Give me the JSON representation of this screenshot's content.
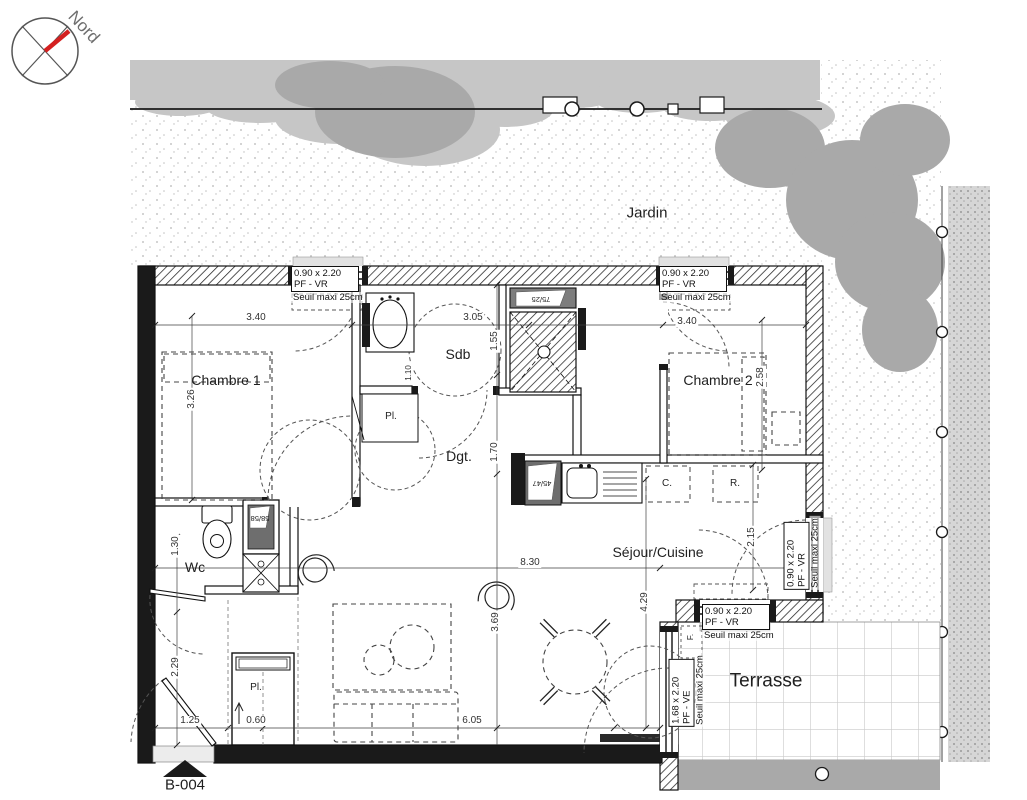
{
  "compass": {
    "north_label": "Nord"
  },
  "areas": {
    "garden": "Jardin",
    "terrace": "Terrasse",
    "unit_ref": "B-004"
  },
  "rooms": {
    "chambre1": "Chambre 1",
    "chambre2": "Chambre 2",
    "bathroom": "Sdb",
    "hallway": "Dgt.",
    "living_kitchen": "Séjour/Cuisine",
    "wc": "Wc",
    "closet_hall": "Pl.",
    "closet_entry": "Pl."
  },
  "openings": {
    "window_top_left": {
      "size": "0.90 x 2.20",
      "type": "PF - VR",
      "sill": "Seuil maxi 25cm"
    },
    "window_top_right": {
      "size": "0.90 x 2.20",
      "type": "PF - VR",
      "sill": "Seuil maxi 25cm"
    },
    "window_right": {
      "size": "0.90 x 2.20",
      "type": "PF - VR",
      "sill": "Seuil maxi 25cm"
    },
    "window_terrace_side": {
      "size": "0.90 x 2.20",
      "type": "PF - VR",
      "sill": "Seuil maxi 25cm"
    },
    "door_terrace": {
      "size": "1.68 x 2.20",
      "type": "PF - VE",
      "sill": "Seuil maxi 25cm"
    }
  },
  "fixtures": {
    "cooker": "C.",
    "fridge": "R.",
    "f_label": "F.",
    "oven_dim": "45/47",
    "shower_dim": "75/25",
    "boiler_dim": "58/58"
  },
  "dimensions": {
    "chambre1_width": "3.40",
    "chambre1_depth": "3.26",
    "bathroom_width": "3.05",
    "bathroom_depth": "1.55",
    "bathroom_left": "1.10",
    "hallway_depth": "1.70",
    "chambre2_width": "3.40",
    "chambre2_depth": "2.58",
    "living_width": "8.30",
    "living_right": "2.15",
    "living_depth_right": "4.29",
    "living_depth_left": "3.69",
    "living_bottom": "6.05",
    "closet_depth": "0.60",
    "entry_width": "1.25",
    "entry_depth": "2.29",
    "wc_depth": "1.30"
  },
  "colors": {
    "compass_needle": "#d42020"
  }
}
